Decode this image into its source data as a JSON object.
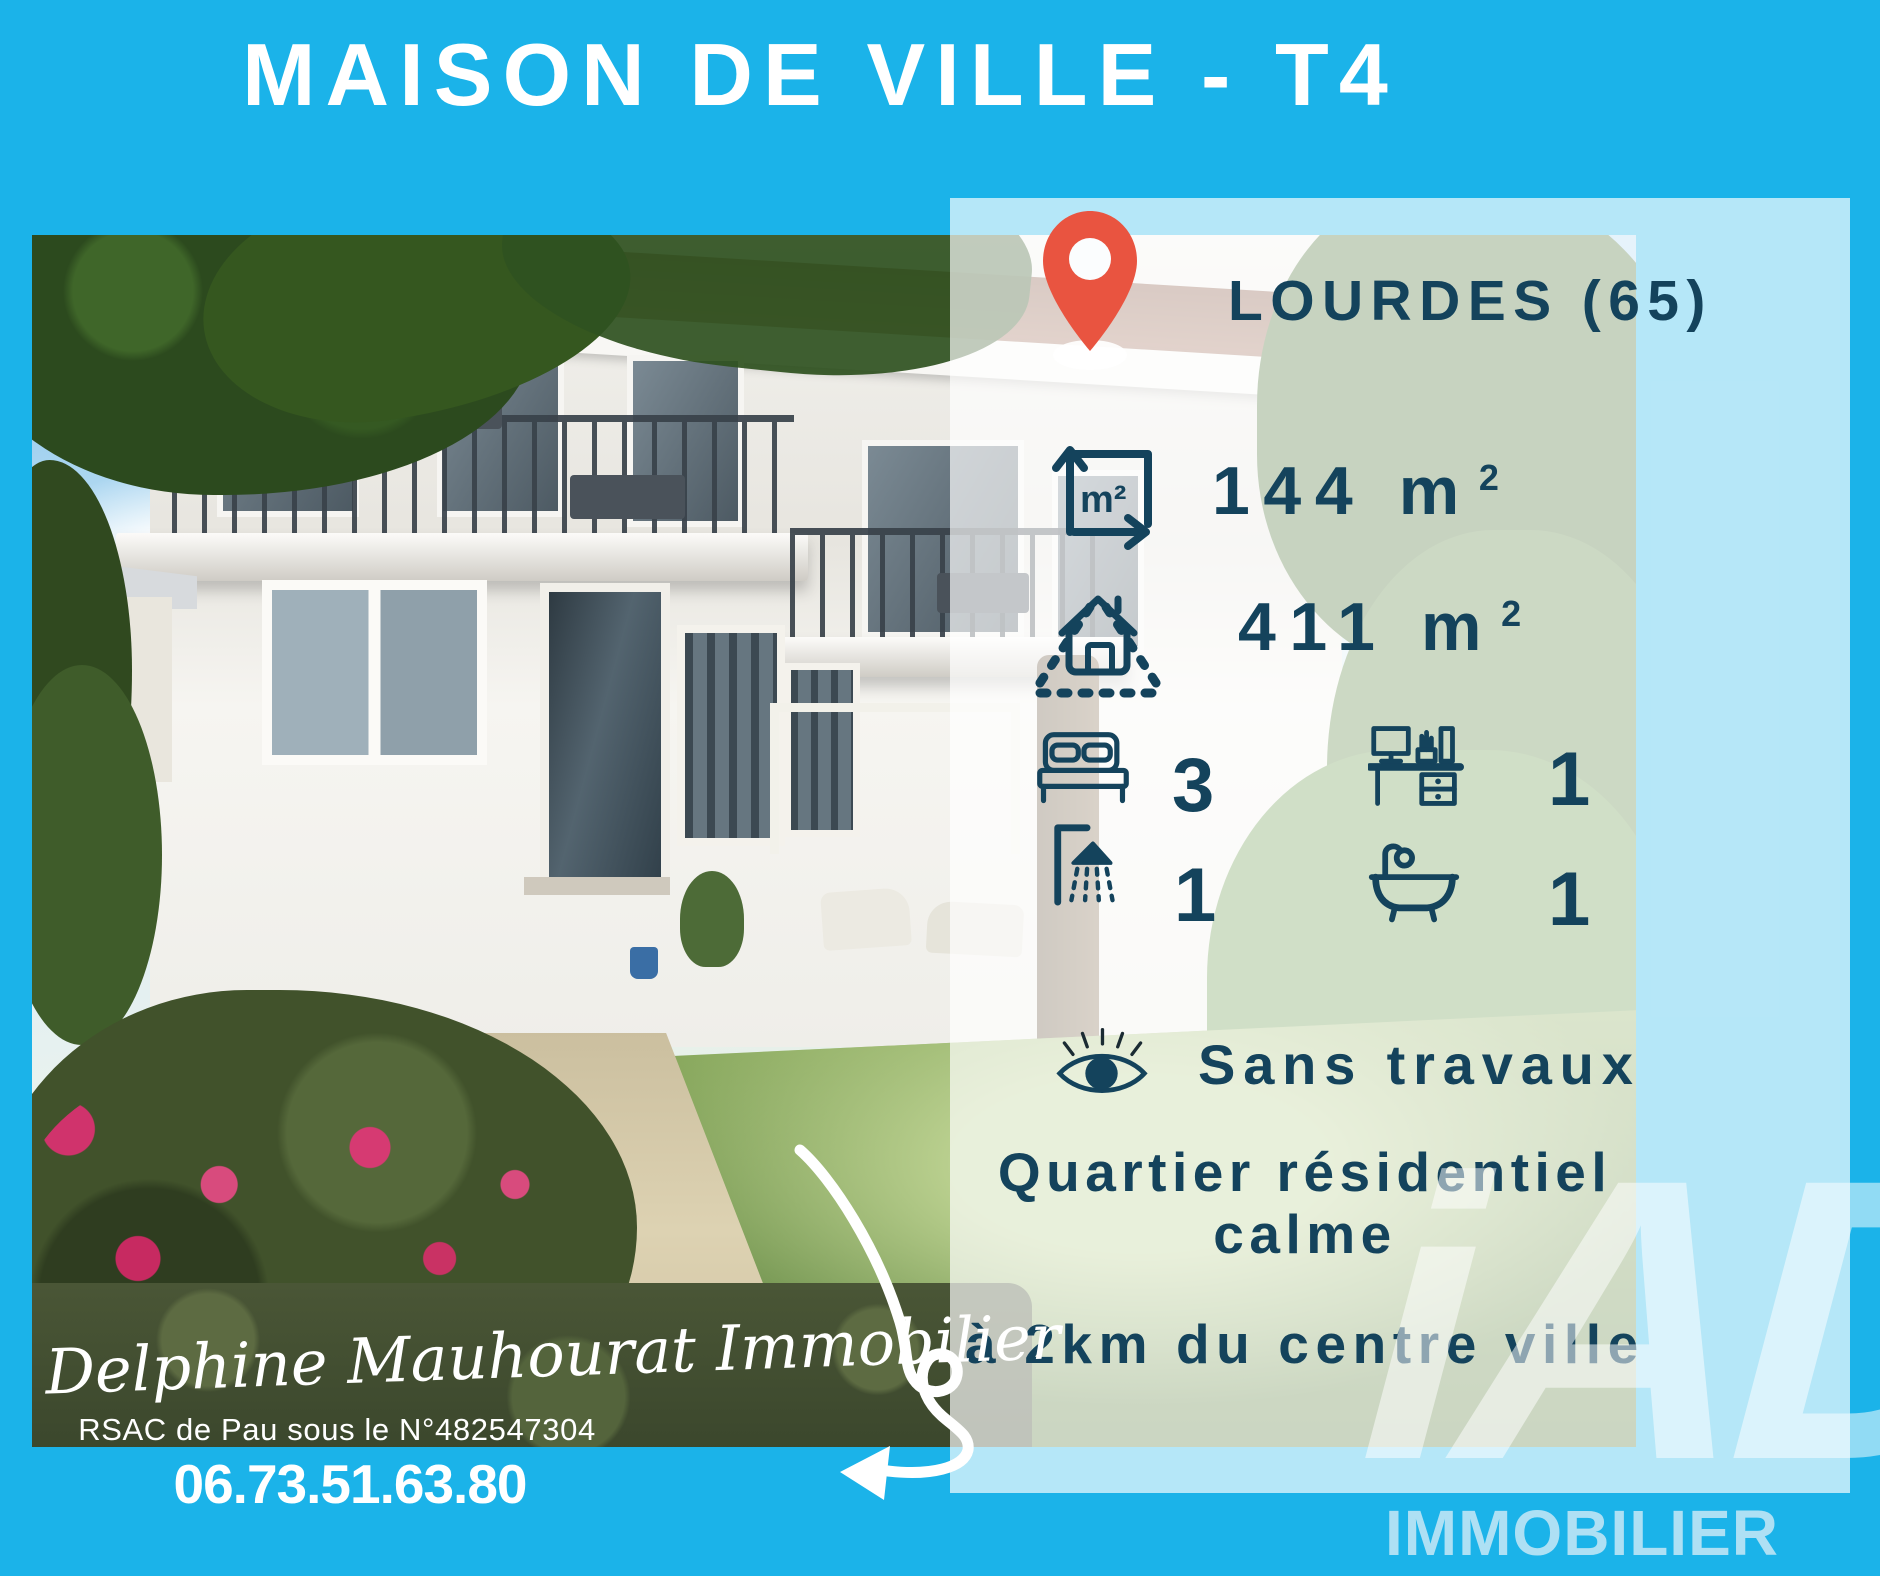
{
  "colors": {
    "cyan": "#1BB3E9",
    "navy": "#14435C",
    "pin_red": "#E95440",
    "pale_blue": "#B8E6F7",
    "white": "#FFFFFF"
  },
  "header": {
    "title": "MAISON DE VILLE - T4"
  },
  "panel": {
    "location": "LOURDES (65)",
    "living_area": {
      "value": "144",
      "unit": "m",
      "sup": "2"
    },
    "land_area": {
      "value": "411",
      "unit": "m",
      "sup": "2"
    },
    "bedrooms": "3",
    "offices": "1",
    "showers": "1",
    "bathtubs": "1",
    "feature_condition": "Sans travaux",
    "feature_area_line1": "Quartier résidentiel",
    "feature_area_line2": "calme",
    "feature_distance": "à 2km du centre ville"
  },
  "agent": {
    "signature": "Delphine Mauhourat Immobilier",
    "rsac": "RSAC de Pau sous le N°482547304",
    "phone": "06.73.51.63.80"
  },
  "brand": {
    "logo": "iAD",
    "wordmark": "IMMOBILIER"
  },
  "icons": {
    "location": "location-pin-icon",
    "living_area": "area-m2-icon",
    "land_area": "land-area-icon",
    "bedrooms": "bed-icon",
    "offices": "desk-icon",
    "showers": "shower-icon",
    "bathtubs": "bathtub-icon",
    "condition": "eye-icon",
    "arrow": "hand-drawn-arrow-icon"
  }
}
